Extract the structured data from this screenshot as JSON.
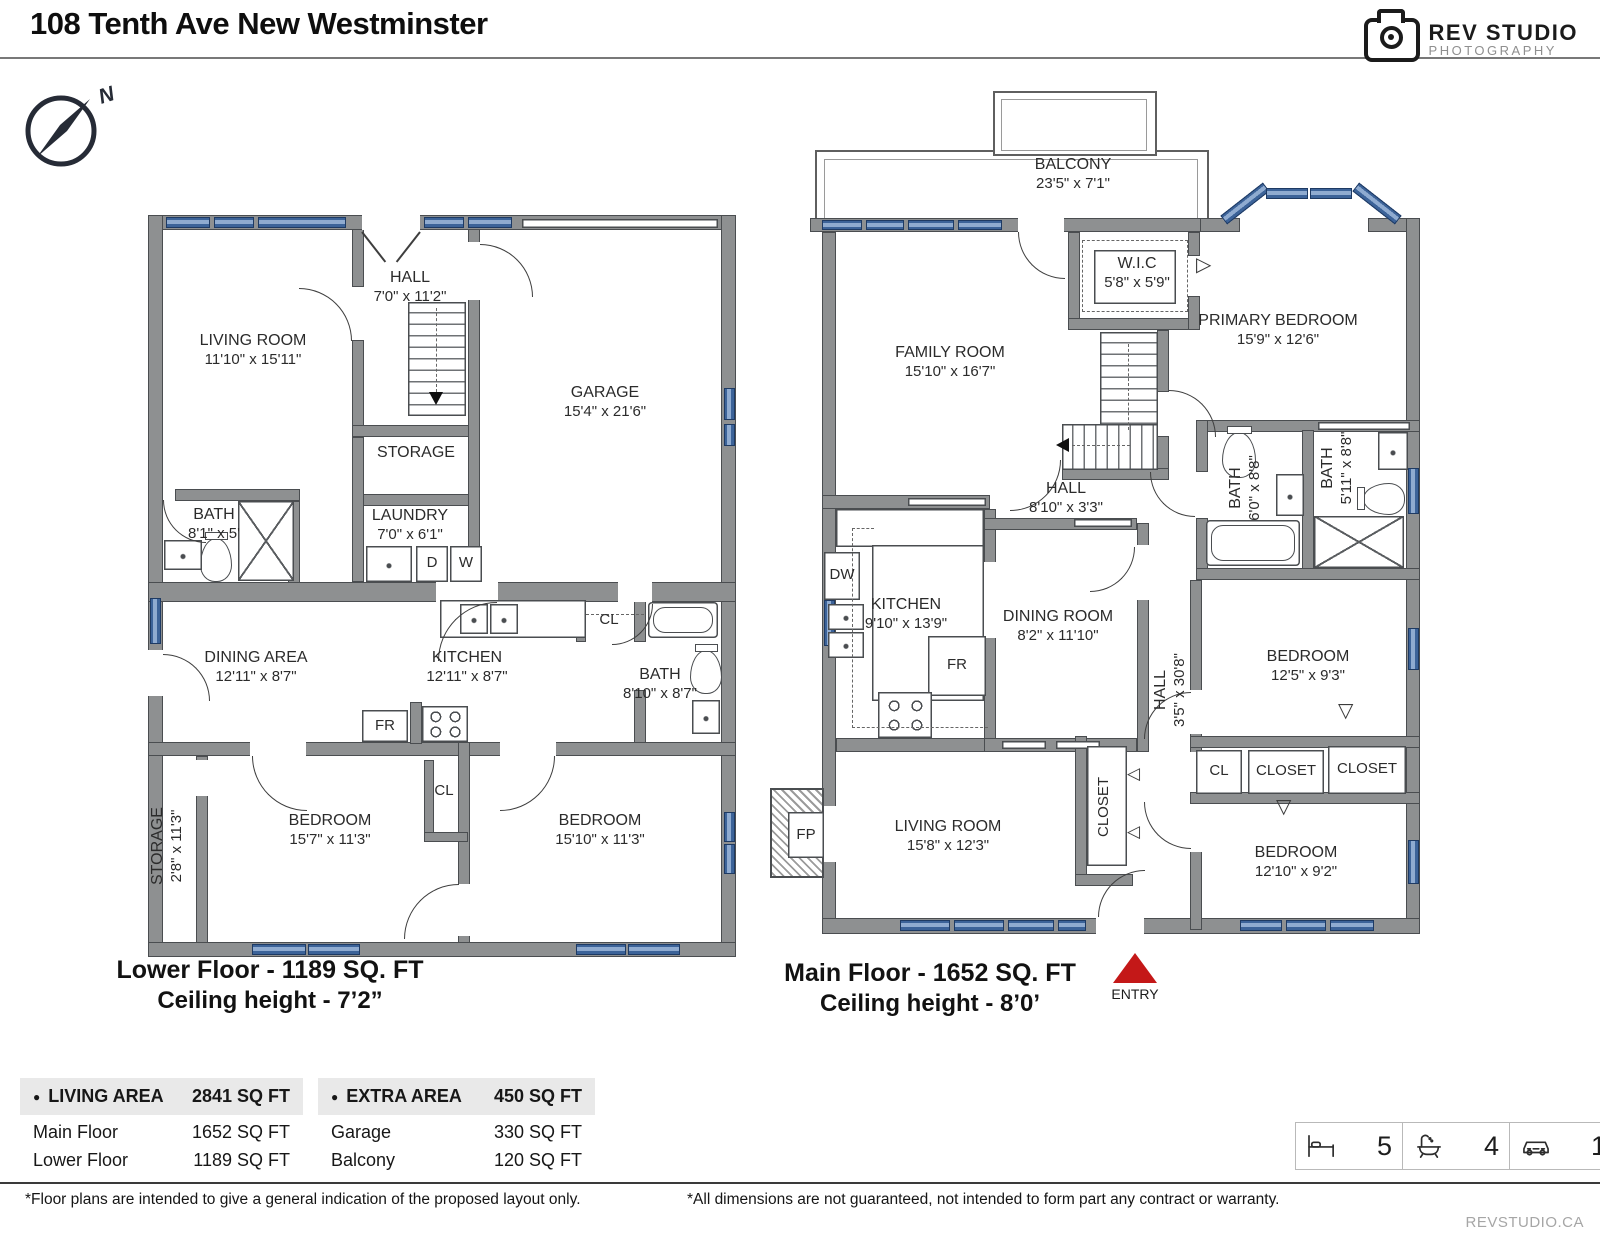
{
  "header": {
    "title": "108 Tenth Ave New Westminster"
  },
  "logo": {
    "name": "REV STUDIO",
    "sub": "PHOTOGRAPHY"
  },
  "compass": {
    "n": "N"
  },
  "lower": {
    "caption": "Lower Floor - 1189 SQ. FT",
    "ceiling": "Ceiling height - 7’2”",
    "rooms": {
      "living": {
        "nm": "LIVING ROOM",
        "dm": "11'10\" x 15'11\""
      },
      "hall": {
        "nm": "HALL",
        "dm": "7'0\" x 11'2\""
      },
      "garage": {
        "nm": "GARAGE",
        "dm": "15'4\" x 21'6\""
      },
      "storage": {
        "nm": "STORAGE"
      },
      "laundry": {
        "nm": "LAUNDRY",
        "dm": "7'0\" x 6'1\""
      },
      "bath1": {
        "nm": "BATH",
        "dm": "8'1\" x 5'"
      },
      "dining": {
        "nm": "DINING AREA",
        "dm": "12'11\" x 8'7\""
      },
      "kitchen": {
        "nm": "KITCHEN",
        "dm": "12'11\" x 8'7\""
      },
      "bath2": {
        "nm": "BATH",
        "dm": "8'10\" x 8'7\""
      },
      "storage2": {
        "nm": "STORAGE",
        "dm": "2'8\" x 11'3\""
      },
      "bedroom1": {
        "nm": "BEDROOM",
        "dm": "15'7\" x 11'3\""
      },
      "bedroom2": {
        "nm": "BEDROOM",
        "dm": "15'10\" x 11'3\""
      }
    },
    "labels": {
      "cl_kitchen": "CL",
      "cl_bedroom": "CL",
      "fr": "FR",
      "d": "D",
      "w": "W"
    }
  },
  "main": {
    "caption": "Main Floor - 1652 SQ. FT",
    "ceiling": "Ceiling height - 8’0’",
    "entry": "ENTRY",
    "rooms": {
      "balcony": {
        "nm": "BALCONY",
        "dm": "23'5\" x 7'1\""
      },
      "wic": {
        "nm": "W.I.C",
        "dm": "5'8\" x 5'9\""
      },
      "primary": {
        "nm": "PRIMARY BEDROOM",
        "dm": "15'9\" x 12'6\""
      },
      "family": {
        "nm": "FAMILY ROOM",
        "dm": "15'10\" x 16'7\""
      },
      "hall1": {
        "nm": "HALL",
        "dm": "8'10\" x 3'3\""
      },
      "bath1": {
        "nm": "BATH",
        "dm": "6'0\" x 8'8\""
      },
      "bath2": {
        "nm": "BATH",
        "dm": "5'11\" x 8'8\""
      },
      "kitchen": {
        "nm": "KITCHEN",
        "dm": "9'10\" x 13'9\""
      },
      "dining": {
        "nm": "DINING ROOM",
        "dm": "8'2\" x 11'10\""
      },
      "hall2": {
        "nm": "HALL",
        "dm": "3'5\" x 30'8\""
      },
      "bedroom1": {
        "nm": "BEDROOM",
        "dm": "12'5\" x 9'3\""
      },
      "bedroom2": {
        "nm": "BEDROOM",
        "dm": "12'10\" x 9'2\""
      },
      "living": {
        "nm": "LIVING ROOM",
        "dm": "15'8\" x 12'3\""
      }
    },
    "labels": {
      "cl": "CL",
      "closet1": "CLOSET",
      "closet2": "CLOSET",
      "closet3": "CLOSET",
      "fp": "FP",
      "dw": "DW",
      "fr": "FR"
    }
  },
  "tables": {
    "bullet": "●",
    "living_area": {
      "title": "LIVING AREA",
      "total": "2841 SQ FT",
      "rows": [
        {
          "label": "Main Floor",
          "value": "1652 SQ FT"
        },
        {
          "label": "Lower Floor",
          "value": "1189 SQ FT"
        }
      ]
    },
    "extra_area": {
      "title": "EXTRA AREA",
      "total": "450 SQ FT",
      "rows": [
        {
          "label": "Garage",
          "value": "330 SQ FT"
        },
        {
          "label": "Balcony",
          "value": "120 SQ FT"
        }
      ]
    }
  },
  "stats": {
    "beds": "5",
    "baths": "4",
    "cars": "1"
  },
  "footer": {
    "left": "*Floor plans are intended to give a general indication of the proposed layout only.",
    "right": "*All dimensions are not guaranteed, not intended to form part any contract or warranty.",
    "site": "REVSTUDIO.CA"
  },
  "icons": {
    "tri_down": "▽",
    "tri_left": "◁",
    "tri_right": "▷"
  }
}
